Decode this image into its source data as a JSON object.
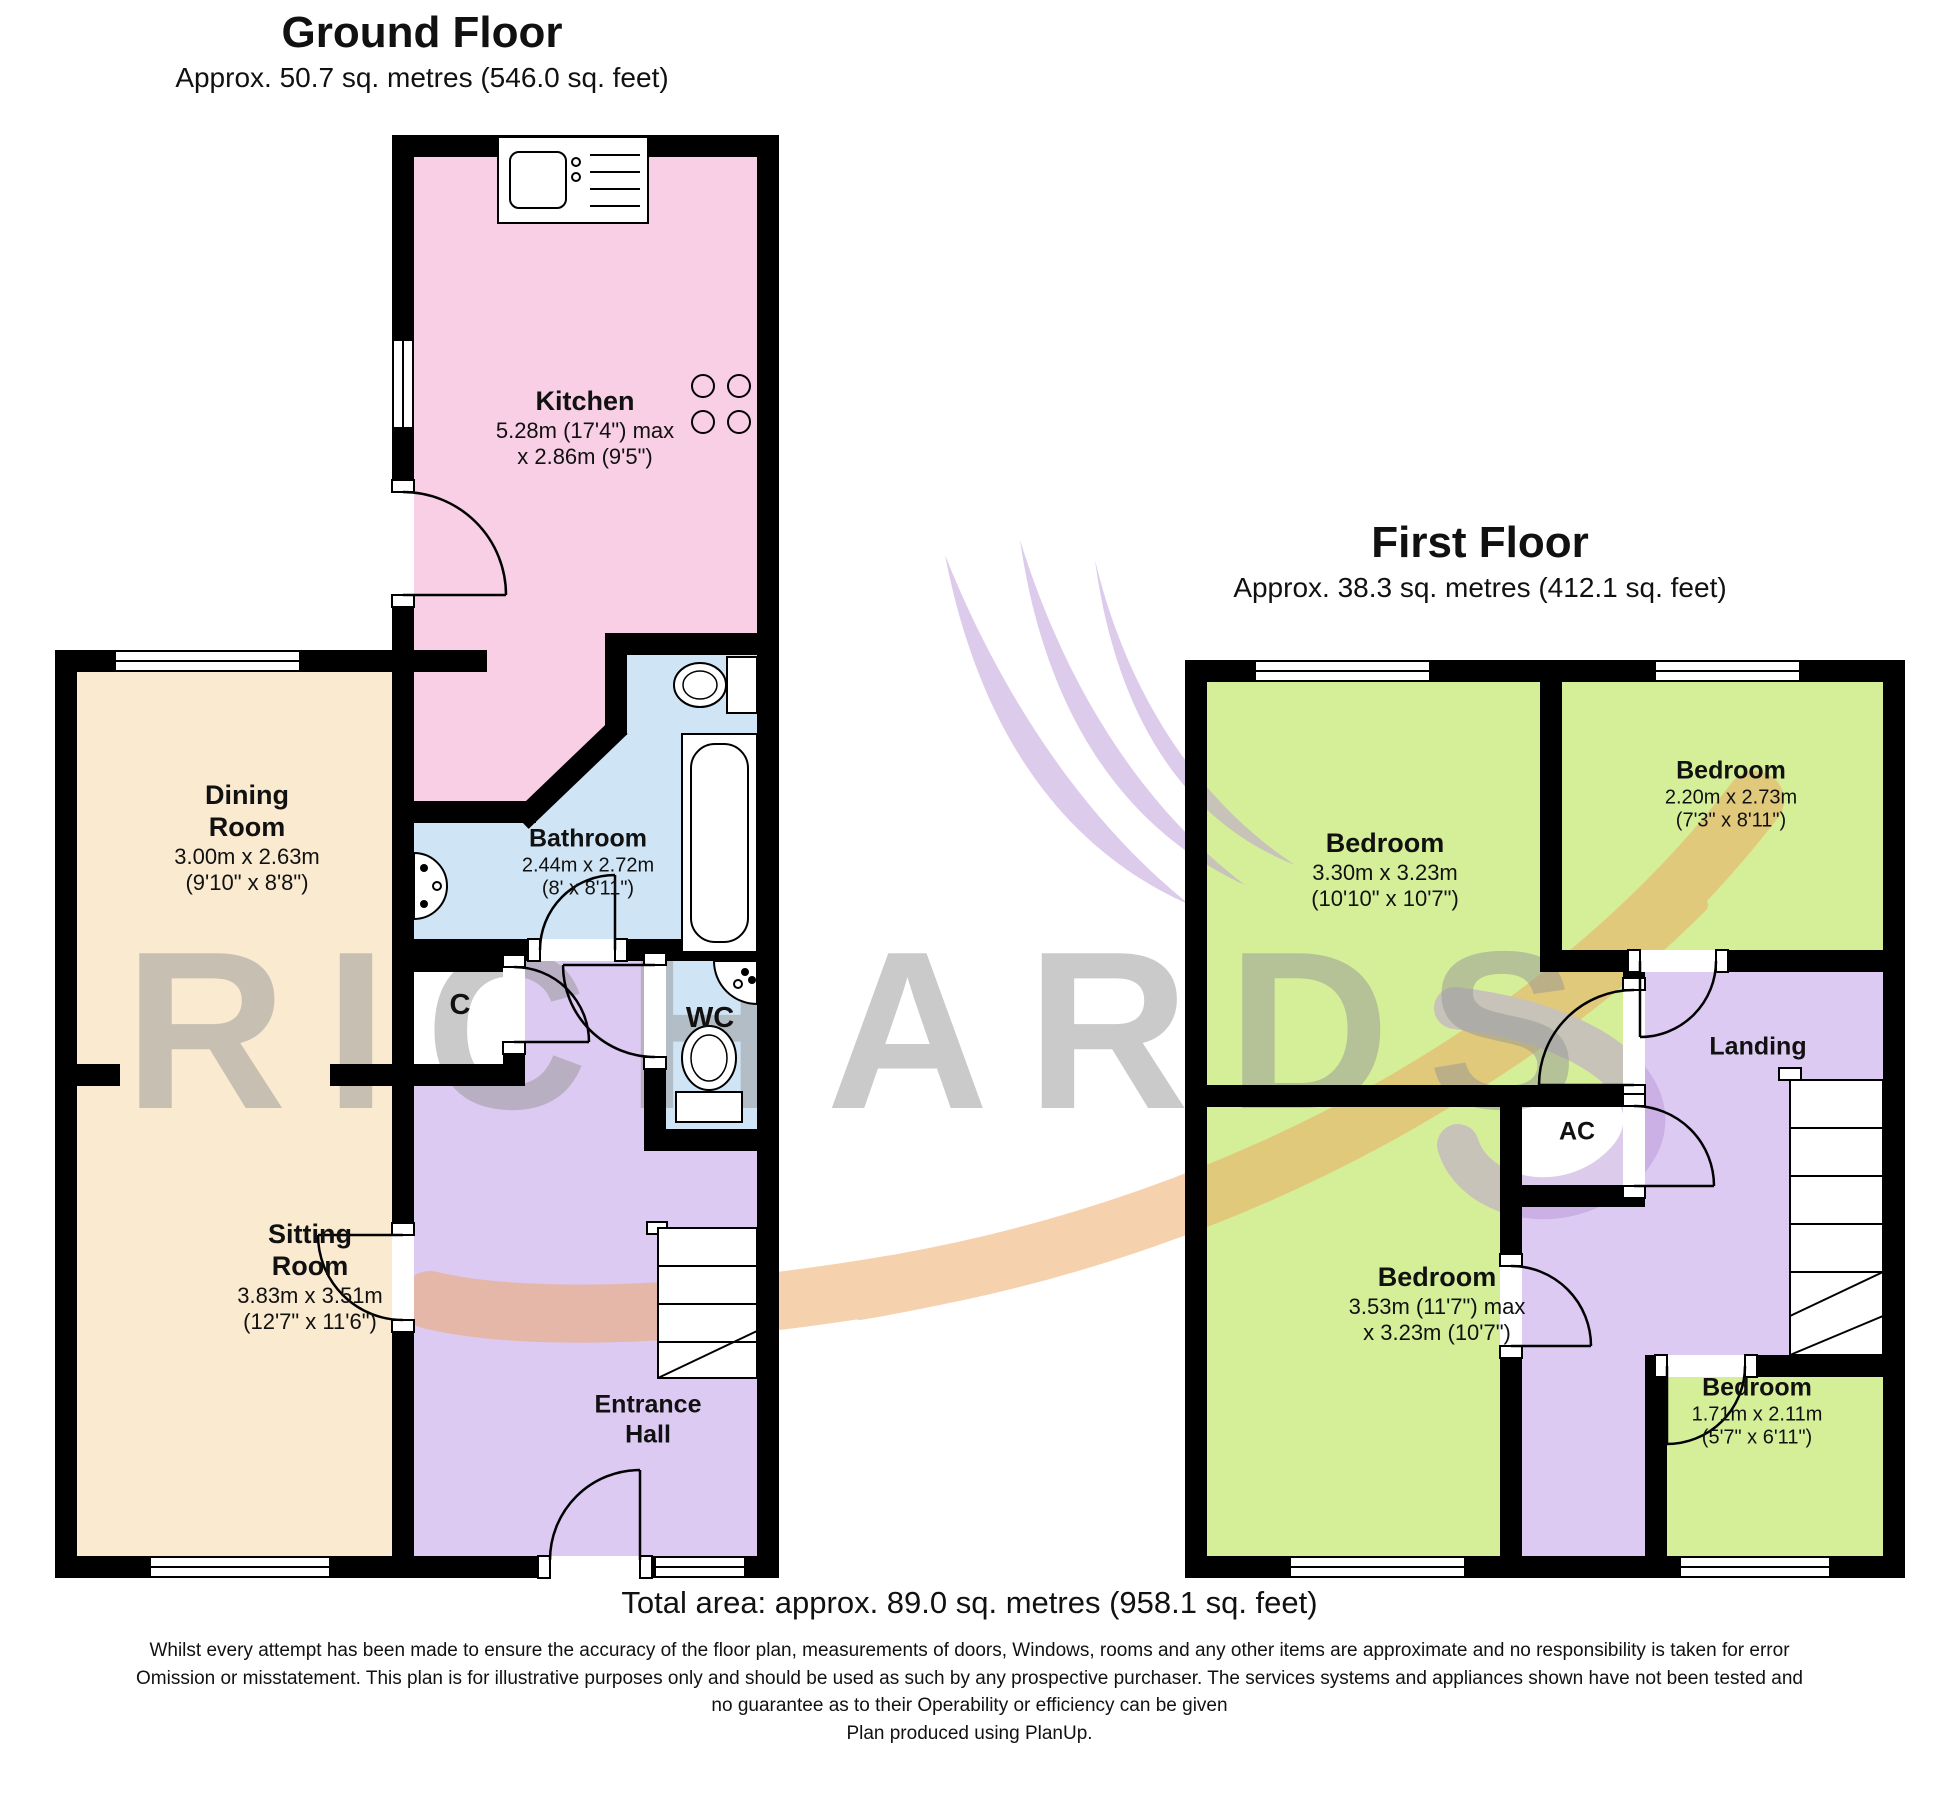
{
  "watermark": {
    "text": "RICHARDS"
  },
  "ground_floor": {
    "title": "Ground Floor",
    "subtitle": "Approx. 50.7 sq. metres (546.0 sq. feet)",
    "rooms": {
      "kitchen": {
        "name": "Kitchen",
        "dims": "5.28m (17'4\") max\nx 2.86m (9'5\")"
      },
      "dining_room": {
        "name": "Dining\nRoom",
        "dims": "3.00m x 2.63m\n(9'10\" x 8'8\")"
      },
      "bathroom": {
        "name": "Bathroom",
        "dims": "2.44m x 2.72m\n(8' x 8'11\")"
      },
      "cupboard": {
        "name": "C"
      },
      "wc": {
        "name": "WC"
      },
      "sitting_room": {
        "name": "Sitting\nRoom",
        "dims": "3.83m x 3.51m\n(12'7\" x 11'6\")"
      },
      "entrance_hall": {
        "name": "Entrance\nHall"
      }
    }
  },
  "first_floor": {
    "title": "First Floor",
    "subtitle": "Approx. 38.3 sq. metres (412.1 sq. feet)",
    "rooms": {
      "bedroom_top_left": {
        "name": "Bedroom",
        "dims": "3.30m x 3.23m\n(10'10\" x 10'7\")"
      },
      "bedroom_top_right": {
        "name": "Bedroom",
        "dims": "2.20m x 2.73m\n(7'3\" x 8'11\")"
      },
      "landing": {
        "name": "Landing"
      },
      "airing_cupboard": {
        "name": "AC"
      },
      "bedroom_bottom_left": {
        "name": "Bedroom",
        "dims": "3.53m (11'7\") max\nx 3.23m (10'7\")"
      },
      "bedroom_bottom_right": {
        "name": "Bedroom",
        "dims": "1.71m x 2.11m\n(5'7\" x 6'11\")"
      }
    }
  },
  "footer": {
    "total_area": "Total area: approx. 89.0 sq. metres (958.1 sq. feet)",
    "disclaimer": "Whilst every attempt has been made to ensure the accuracy of the floor plan, measurements of doors, Windows, rooms and any other items are approximate and no responsibility is taken for error Omission or misstatement. This plan is for illustrative purposes only and should be used as such by any prospective purchaser. The services systems and appliances shown have not been tested and no guarantee as to their Operability or efficiency can be given",
    "produced": "Plan produced using PlanUp."
  },
  "colors": {
    "kitchen": "#f8cfe5",
    "bath": "#cfe5f6",
    "cream": "#faeacf",
    "hall": "#dccaf2",
    "bedroom": "#d5ef99",
    "wall": "#000000",
    "wm-gray": "#969696",
    "wm-orange": "#eda45f",
    "wm-purple": "#bc98d9"
  }
}
